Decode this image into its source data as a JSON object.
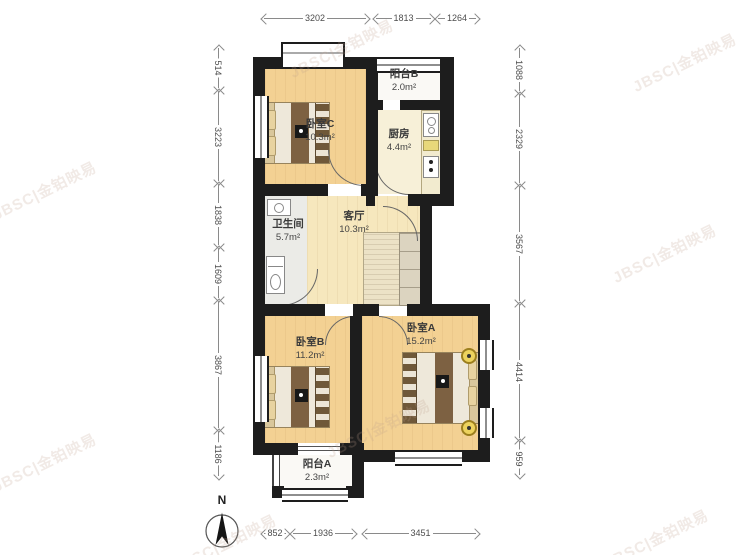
{
  "page": {
    "background": "#ffffff"
  },
  "watermark": {
    "text": "JBSC|金铂映易"
  },
  "compass": {
    "north_label": "N"
  },
  "rooms": {
    "bedroomC": {
      "name": "卧室C",
      "area": "10.3m²"
    },
    "balconyB": {
      "name": "阳台B",
      "area": "2.0m²"
    },
    "kitchen": {
      "name": "厨房",
      "area": "4.4m²"
    },
    "bathroom": {
      "name": "卫生间",
      "area": "5.7m²"
    },
    "living": {
      "name": "客厅",
      "area": "10.3m²"
    },
    "bedroomB": {
      "name": "卧室B",
      "area": "11.2m²"
    },
    "bedroomA": {
      "name": "卧室A",
      "area": "15.2m²"
    },
    "balconyA": {
      "name": "阳台A",
      "area": "2.3m²"
    }
  },
  "dimensions": {
    "top": [
      "3202",
      "1813",
      "1264"
    ],
    "left": [
      "514",
      "3223",
      "1838",
      "1609",
      "3867",
      "1186"
    ],
    "right": [
      "1088",
      "2329",
      "3567",
      "4414",
      "959"
    ],
    "bottom": [
      "852",
      "1936",
      "3451"
    ]
  },
  "colors": {
    "wall": "#1d1d1d",
    "floor_bedroom": "#f3d193",
    "floor_living": "#f6e7bd",
    "floor_kitchen": "#f7f0d8",
    "floor_bathroom": "#ebebe7",
    "floor_balcony": "#faf9f5",
    "dimension_text": "#4d4d4d"
  }
}
